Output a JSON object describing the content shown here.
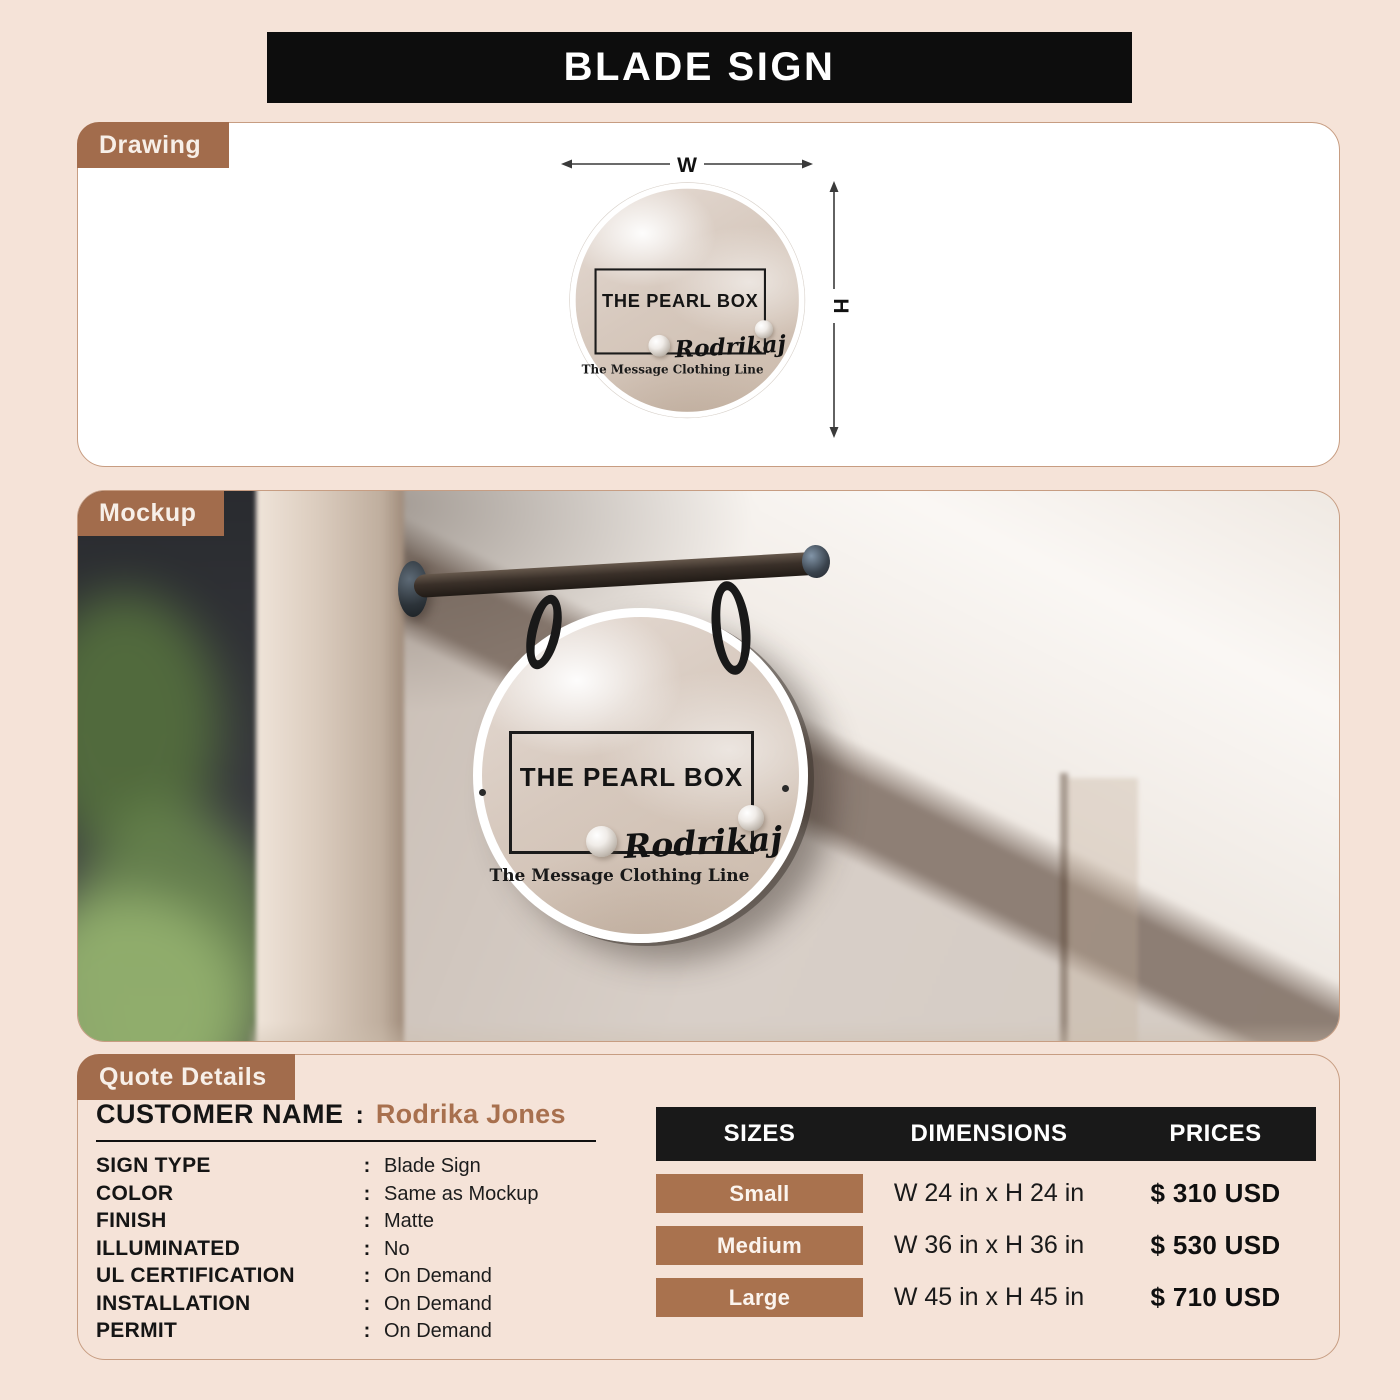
{
  "header": {
    "title": "BLADE SIGN"
  },
  "sections": {
    "drawing": "Drawing",
    "mockup": "Mockup",
    "quote": "Quote Details"
  },
  "sign_artwork": {
    "brand": "THE PEARL BOX",
    "owner_script": "Rodrikaj",
    "tagline": "The Message Clothing Line"
  },
  "drawing": {
    "width_label": "W",
    "height_label": "H"
  },
  "quote": {
    "customer_label": "CUSTOMER NAME",
    "separator": ":",
    "customer_name": "Rodrika Jones",
    "specs": [
      {
        "label": "SIGN TYPE",
        "value": "Blade Sign"
      },
      {
        "label": "COLOR",
        "value": "Same as Mockup"
      },
      {
        "label": "FINISH",
        "value": "Matte"
      },
      {
        "label": "ILLUMINATED",
        "value": "No"
      },
      {
        "label": "UL CERTIFICATION",
        "value": "On Demand"
      },
      {
        "label": "INSTALLATION",
        "value": "On Demand"
      },
      {
        "label": "PERMIT",
        "value": "On Demand"
      }
    ]
  },
  "pricing_table": {
    "headers": [
      "SIZES",
      "DIMENSIONS",
      "PRICES"
    ],
    "rows": [
      {
        "size": "Small",
        "dimensions": "W 24 in x H 24 in",
        "price": "$ 310 USD"
      },
      {
        "size": "Medium",
        "dimensions": "W 36 in x H 36 in",
        "price": "$ 530 USD"
      },
      {
        "size": "Large",
        "dimensions": "W 45 in x H 45 in",
        "price": "$ 710 USD"
      }
    ]
  },
  "colors": {
    "page_bg": "#f5e3d8",
    "accent_brown": "#a26c4c",
    "badge_brown": "#a9724e",
    "customer_name_brown": "#a8704e",
    "banner_black": "#0d0d0d",
    "table_header_black": "#191919"
  }
}
